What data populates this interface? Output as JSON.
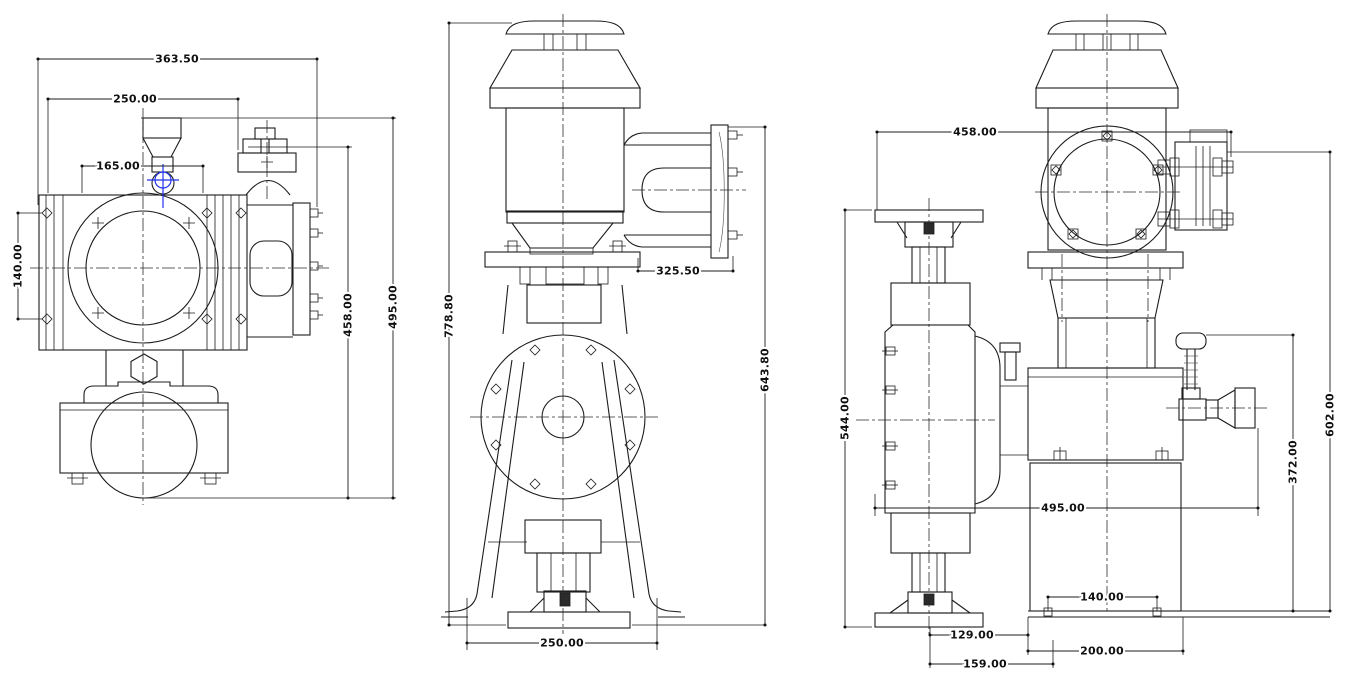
{
  "colors": {
    "line": "#1c1c1c",
    "accent_blue": "#2233ee",
    "background": "#ffffff"
  },
  "views": {
    "top": {
      "dims": {
        "overall_width": "363.50",
        "flange_width": "250.00",
        "port_offset": "165.00",
        "bolt_spacing": "140.00",
        "depth_to_valve": "458.00",
        "overall_depth": "495.00"
      }
    },
    "front": {
      "dims": {
        "overall_height": "778.80",
        "head_height": "643.80",
        "head_extension": "325.50",
        "foot_width": "250.00"
      }
    },
    "side": {
      "dims": {
        "top_width": "458.00",
        "column_height": "544.00",
        "flange_height": "602.00",
        "valve_height": "372.00",
        "mid_width": "495.00",
        "slot_spacing": "140.00",
        "base_offset_a": "129.00",
        "base_length": "200.00",
        "base_offset_b": "159.00"
      }
    }
  }
}
